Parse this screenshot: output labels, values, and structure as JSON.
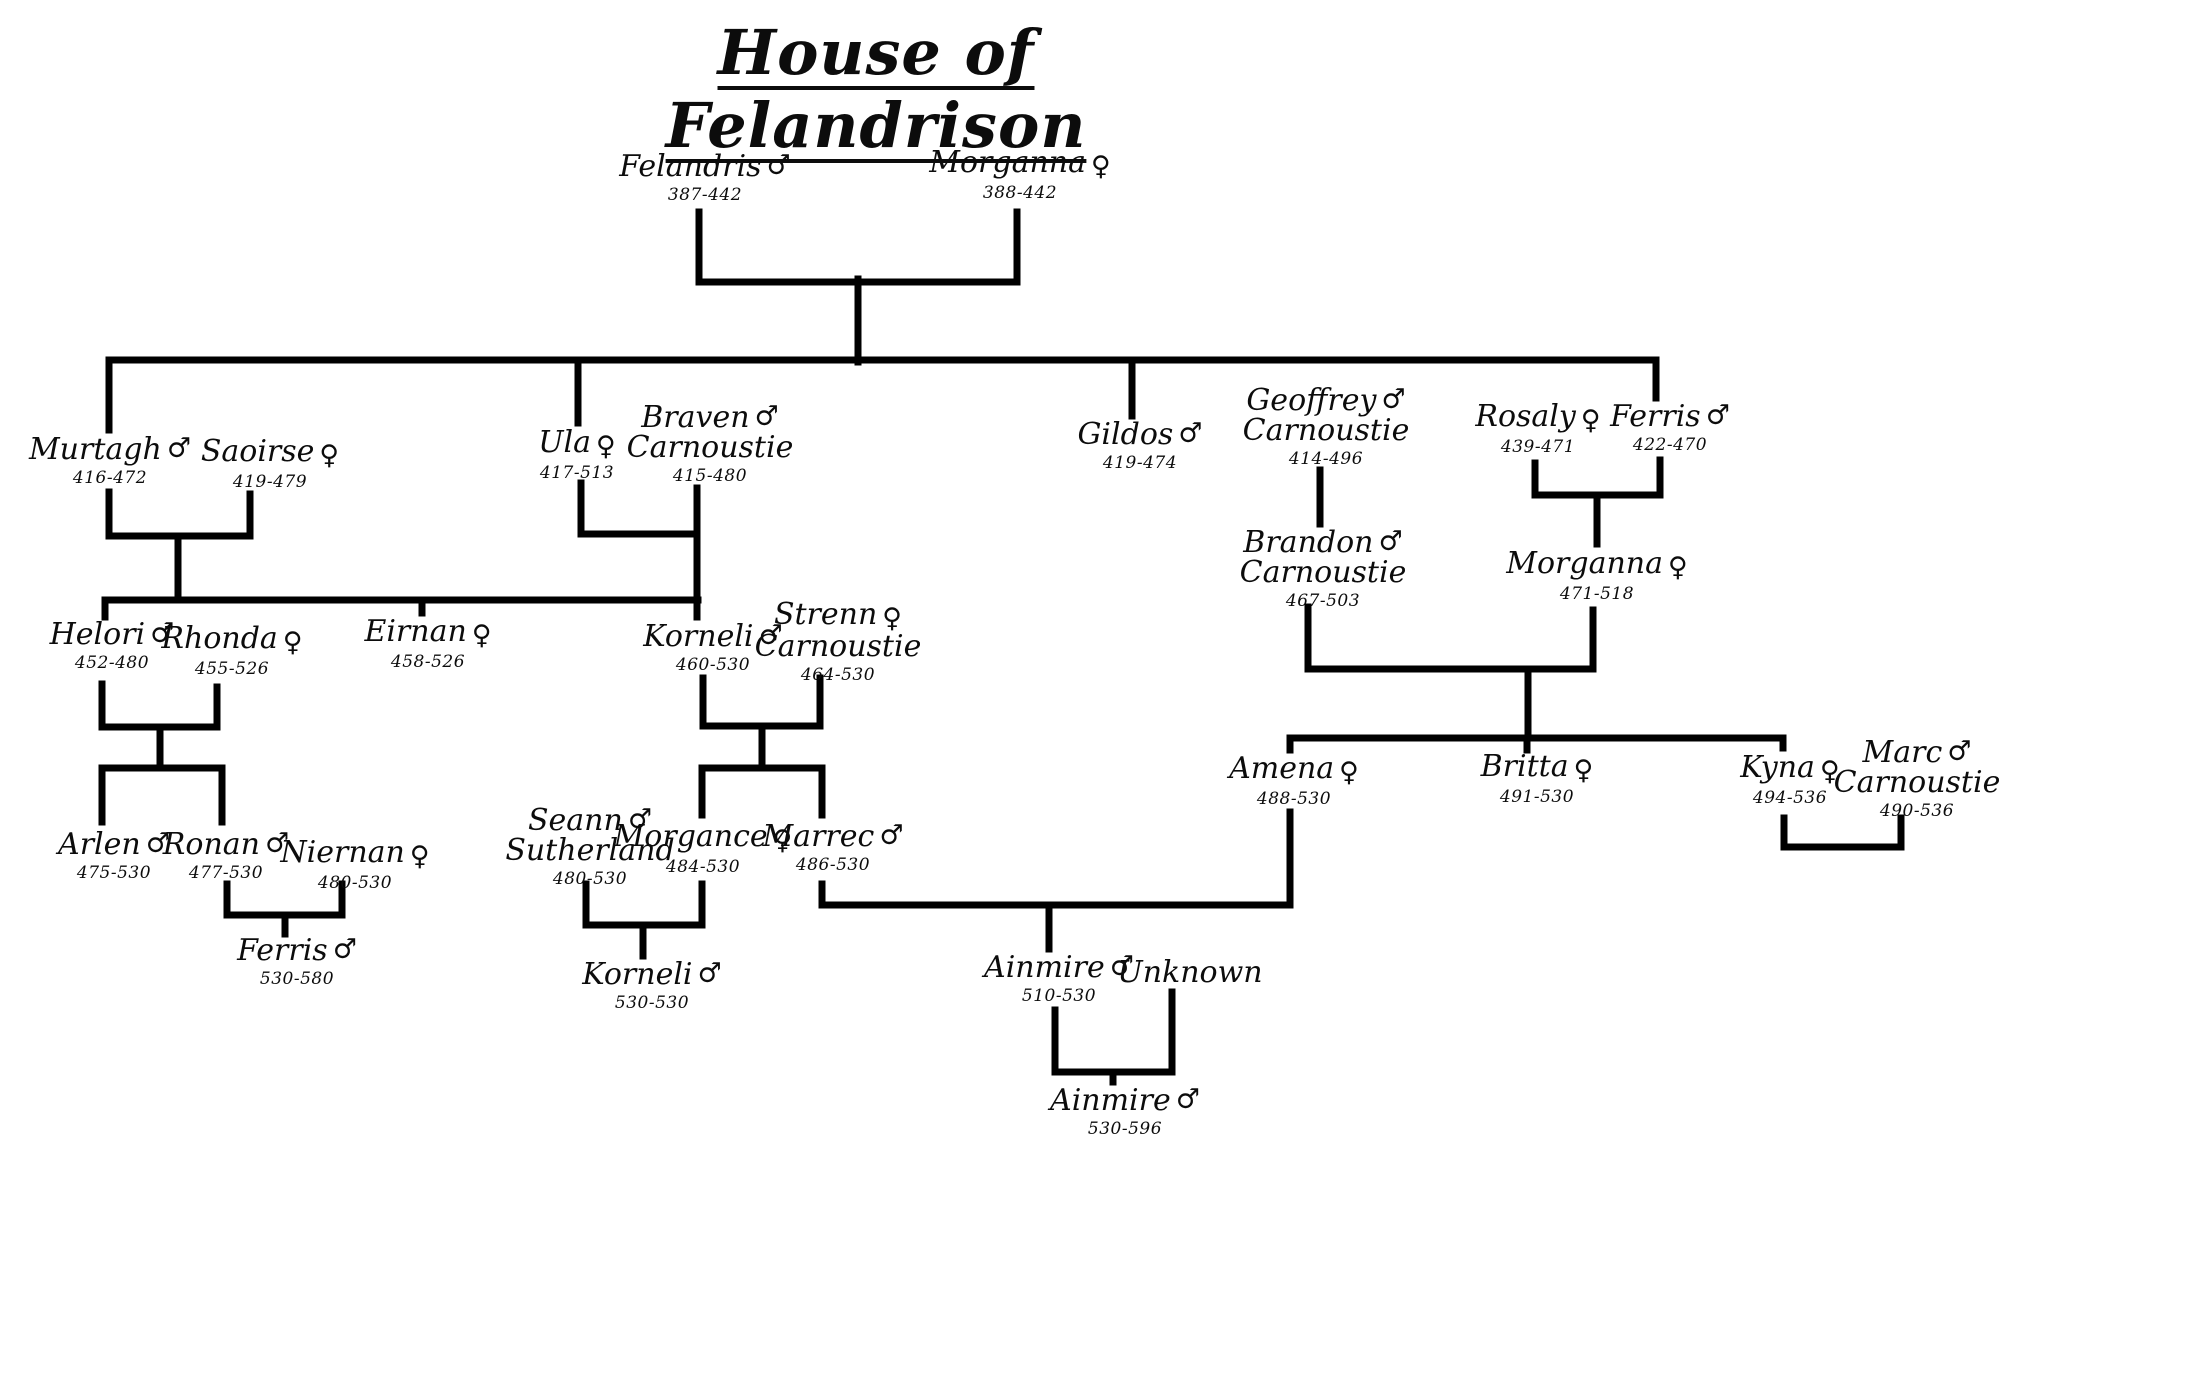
{
  "title": "House of Felandrison",
  "colors": {
    "line": "#000000",
    "background": "#ffffff",
    "text": "#0c0c0c"
  },
  "people": [
    {
      "name": "Felandris",
      "surname": "",
      "symbol": "♂",
      "gender": "male",
      "dates": "387-442"
    },
    {
      "name": "Morganna",
      "surname": "",
      "symbol": "♀",
      "gender": "female",
      "dates": "388-442"
    },
    {
      "name": "Murtagh",
      "surname": "",
      "symbol": "♂",
      "gender": "male",
      "dates": "416-472"
    },
    {
      "name": "Saoirse",
      "surname": "",
      "symbol": "♀",
      "gender": "female",
      "dates": "419-479"
    },
    {
      "name": "Ula",
      "surname": "",
      "symbol": "♀",
      "gender": "female",
      "dates": "417-513"
    },
    {
      "name": "Braven",
      "surname": "Carnoustie",
      "symbol": "♂",
      "gender": "male",
      "dates": "415-480"
    },
    {
      "name": "Gildos",
      "surname": "",
      "symbol": "♂",
      "gender": "male",
      "dates": "419-474"
    },
    {
      "name": "Geoffrey",
      "surname": "Carnoustie",
      "symbol": "♂",
      "gender": "male",
      "dates": "414-496"
    },
    {
      "name": "Rosaly",
      "surname": "",
      "symbol": "♀",
      "gender": "female",
      "dates": "439-471"
    },
    {
      "name": "Ferris",
      "surname": "",
      "symbol": "♂",
      "gender": "male",
      "dates": "422-470"
    },
    {
      "name": "Helori",
      "surname": "",
      "symbol": "♂",
      "gender": "male",
      "dates": "452-480"
    },
    {
      "name": "Rhonda",
      "surname": "",
      "symbol": "♀",
      "gender": "female",
      "dates": "455-526"
    },
    {
      "name": "Eirnan",
      "surname": "",
      "symbol": "♀",
      "gender": "female",
      "dates": "458-526"
    },
    {
      "name": "Korneli",
      "surname": "",
      "symbol": "♂",
      "gender": "male",
      "dates": "460-530"
    },
    {
      "name": "Strenn",
      "surname": "Carnoustie",
      "symbol": "♀",
      "gender": "female",
      "dates": "464-530"
    },
    {
      "name": "Brandon",
      "surname": "Carnoustie",
      "symbol": "♂",
      "gender": "male",
      "dates": "467-503"
    },
    {
      "name": "Morganna",
      "surname": "",
      "symbol": "♀",
      "gender": "female",
      "dates": "471-518"
    },
    {
      "name": "Arlen",
      "surname": "",
      "symbol": "♂",
      "gender": "male",
      "dates": "475-530"
    },
    {
      "name": "Ronan",
      "surname": "",
      "symbol": "♂",
      "gender": "male",
      "dates": "477-530"
    },
    {
      "name": "Niernan",
      "surname": "",
      "symbol": "♀",
      "gender": "female",
      "dates": "480-530"
    },
    {
      "name": "Seann",
      "surname": "Sutherland",
      "symbol": "♂",
      "gender": "male",
      "dates": "480-530"
    },
    {
      "name": "Morgance",
      "surname": "",
      "symbol": "♀",
      "gender": "female",
      "dates": "484-530"
    },
    {
      "name": "Marrec",
      "surname": "",
      "symbol": "♂",
      "gender": "male",
      "dates": "486-530"
    },
    {
      "name": "Amena",
      "surname": "",
      "symbol": "♀",
      "gender": "female",
      "dates": "488-530"
    },
    {
      "name": "Britta",
      "surname": "",
      "symbol": "♀",
      "gender": "female",
      "dates": "491-530"
    },
    {
      "name": "Kyna",
      "surname": "",
      "symbol": "♀",
      "gender": "female",
      "dates": "494-536"
    },
    {
      "name": "Marc",
      "surname": "Carnoustie",
      "symbol": "♂",
      "gender": "male",
      "dates": "490-536"
    },
    {
      "name": "Ferris",
      "surname": "",
      "symbol": "♂",
      "gender": "male",
      "dates": "530-580"
    },
    {
      "name": "Korneli",
      "surname": "",
      "symbol": "♂",
      "gender": "male",
      "dates": "530-530"
    },
    {
      "name": "Ainmire",
      "surname": "",
      "symbol": "♂",
      "gender": "male",
      "dates": "510-530"
    },
    {
      "name": "Unknown",
      "surname": "",
      "symbol": "",
      "gender": "",
      "dates": ""
    },
    {
      "name": "Ainmire",
      "surname": "",
      "symbol": "♂",
      "gender": "male",
      "dates": "530-596"
    }
  ]
}
